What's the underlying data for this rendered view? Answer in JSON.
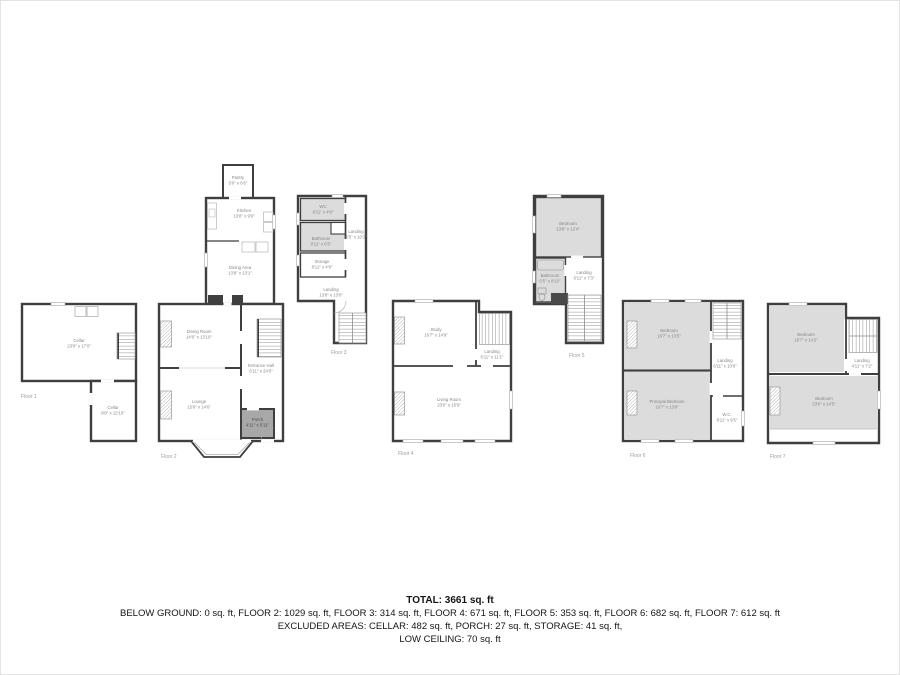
{
  "footer": {
    "total": "TOTAL: 3661 sq. ft",
    "by_floor": "BELOW GROUND: 0 sq. ft, FLOOR 2: 1029 sq. ft, FLOOR 3: 314 sq. ft, FLOOR 4: 671 sq. ft, FLOOR 5: 353 sq. ft, FLOOR 6: 682 sq. ft, FLOOR 7: 612 sq. ft",
    "excluded": "EXCLUDED AREAS: CELLAR: 482 sq. ft, PORCH: 27 sq. ft, STORAGE: 41 sq. ft,",
    "low_ceiling": "LOW CEILING: 70 sq. ft"
  },
  "colors": {
    "wall": "#3f3f3f",
    "room_gray": "#dcdcdc",
    "porch_gray": "#a8a8a8",
    "label_gray": "#868686"
  },
  "floors": [
    {
      "label": "Floor 1",
      "rooms": [
        {
          "name": "Cellar",
          "dims": "23'0\" x 17'0\""
        },
        {
          "name": "Cellar",
          "dims": "8'8\" x 12'10\""
        }
      ]
    },
    {
      "label": "Floor 2",
      "rooms": [
        {
          "name": "Pantry",
          "dims": "5'0\" x 6'6\""
        },
        {
          "name": "Kitchen",
          "dims": "13'8\" x 9'9\""
        },
        {
          "name": "Dining Area",
          "dims": "13'8\" x 13'1\""
        },
        {
          "name": "Dining Room",
          "dims": "14'6\" x 13'10\""
        },
        {
          "name": "Entrance Hall",
          "dims": "6'11\" x 24'0\""
        },
        {
          "name": "Lounge",
          "dims": "15'6\" x 14'6\""
        },
        {
          "name": "Porch",
          "dims": "4'11\" x 5'11\""
        }
      ]
    },
    {
      "label": "Floor 3",
      "rooms": [
        {
          "name": "WC",
          "dims": "8'11\" x 4'9\""
        },
        {
          "name": "Bathroom",
          "dims": "8'11\" x 6'5\""
        },
        {
          "name": "Storage",
          "dims": "8'11\" x 4'9\""
        },
        {
          "name": "Landing",
          "dims": "4'5\" x 10'3\""
        },
        {
          "name": "Landing",
          "dims": "13'8\" x 13'0\""
        }
      ]
    },
    {
      "label": "Floor 4",
      "rooms": [
        {
          "name": "Study",
          "dims": "16'7\" x 14'9\""
        },
        {
          "name": "Landing",
          "dims": "6'11\" x 11'1\""
        },
        {
          "name": "Living Room",
          "dims": "23'0\" x 15'9\""
        }
      ]
    },
    {
      "label": "Floor 5",
      "rooms": [
        {
          "name": "Bedroom",
          "dims": "13'8\" x 12'4\""
        },
        {
          "name": "Bathroom",
          "dims": "6'5\" x 8'10\""
        },
        {
          "name": "Landing",
          "dims": "6'11\" x 7'3\""
        }
      ]
    },
    {
      "label": "Floor 6",
      "rooms": [
        {
          "name": "Bedroom",
          "dims": "16'7\" x 13'5\""
        },
        {
          "name": "Landing",
          "dims": "6'11\" x 10'0\""
        },
        {
          "name": "Principal Bedroom",
          "dims": "16'7\" x 13'9\""
        },
        {
          "name": "W.C.",
          "dims": "6'11\" x 9'5\""
        }
      ]
    },
    {
      "label": "Floor 7",
      "rooms": [
        {
          "name": "Bedroom",
          "dims": "16'7\" x 14'2\""
        },
        {
          "name": "Landing",
          "dims": "4'11\" x 7'2\""
        },
        {
          "name": "Bedroom",
          "dims": "23'0\" x 14'5\""
        }
      ]
    }
  ]
}
